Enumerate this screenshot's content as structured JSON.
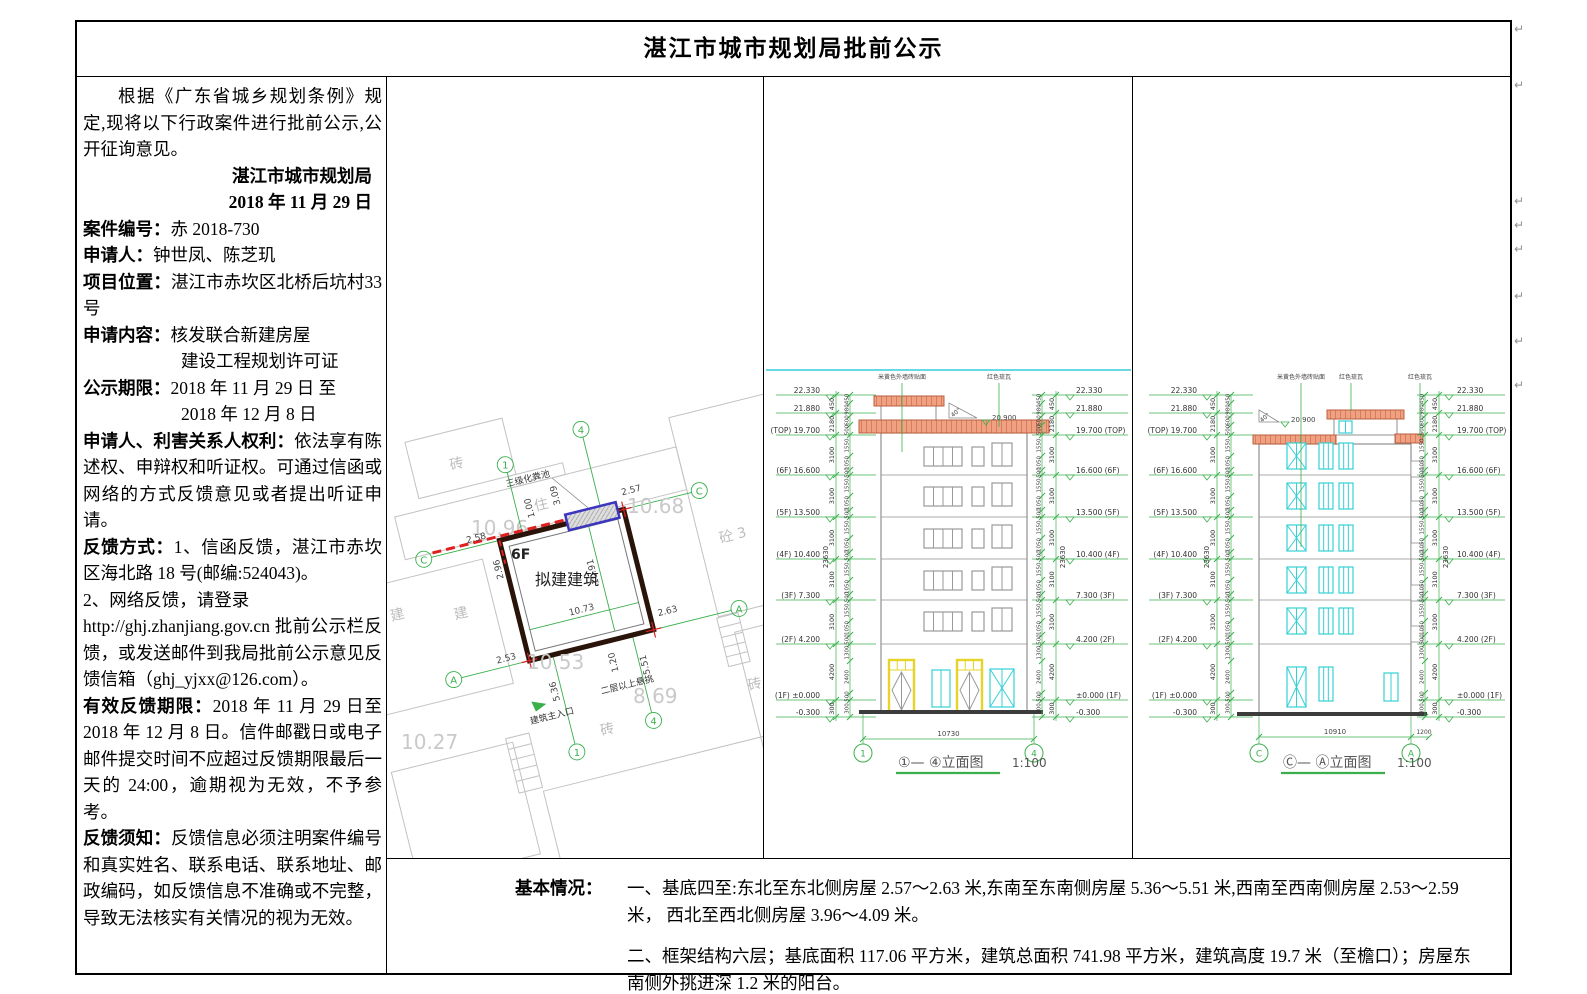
{
  "title": "湛江市城市规划局批前公示",
  "left_panel": {
    "intro": "根据《广东省城乡规划条例》规定,现将以下行政案件进行批前公示,公开征询意见。",
    "agency": "湛江市城市规划局",
    "date": "2018 年 11 月 29 日",
    "case_no_label": "案件编号：",
    "case_no": "赤 2018-730",
    "applicant_label": "申请人：",
    "applicant": "钟世凤、陈芝玑",
    "location_label": "项目位置：",
    "location": "湛江市赤坎区北桥后坑村33 号",
    "content_label": "申请内容：",
    "content1": "核发联合新建房屋",
    "content2": "建设工程规划许可证",
    "period_label": "公示期限：",
    "period1": "2018 年 11 月 29 日  至",
    "period2": "2018 年 12 月 8 日",
    "rights_label": "申请人、利害关系人权利：",
    "rights": "依法享有陈述权、申辩权和听证权。可通过信函或网络的方式反馈意见或者提出听证申请。",
    "feedback_label": "反馈方式：",
    "feedback1": "1、信函反馈，湛江市赤坎区海北路 18 号(邮编:524043)。",
    "feedback2": "2、网络反馈，请登录",
    "feedback3": "http://ghj.zhanjiang.gov.cn 批前公示栏反馈，或发送邮件到我局批前公示意见反馈信箱（ghj_yjxx@126.com）。",
    "deadline_label": "有效反馈期限：",
    "deadline": "2018 年 11 月 29 日至 2018 年 12 月 8 日。信件邮戳日或电子邮件提交时间不应超过反馈期限最后一天的 24:00，逾期视为无效，不予参考。",
    "notice_label": "反馈须知：",
    "notice": "反馈信息必须注明案件编号和真实姓名、联系电话、联系地址、邮政编码，如反馈信息不准确或不完整，导致无法核实有关情况的视为无效。"
  },
  "basic_info": {
    "label": "基本情况：",
    "item1": "一、基底四至:东北至东北侧房屋 2.57～2.63 米,东南至东南侧房屋 5.36～5.51 米,西南至西南侧房屋 2.53～2.59 米， 西北至西北侧房屋 3.96～4.09 米。",
    "item2": "二、框架结构六层；基底面积 117.06 平方米，建筑总面积 741.98 平方米，建筑高度 19.7 米（至檐口）；房屋东南侧外挑进深 1.2 米的阳台。"
  },
  "site_plan": {
    "building_label": "拟建建筑",
    "floors_label": "6F",
    "septic_label": "三级化粪池",
    "entrance_label": "建筑主入口",
    "cantilever_label": "二层以上悬挑",
    "dims": {
      "d257": "2.57",
      "d263": "2.63",
      "d258": "2.58",
      "d253": "2.53",
      "d536": "5.36",
      "d551": "5.51",
      "d120": "1.20",
      "d100": "1.00",
      "d309": "3.09",
      "d296": "2.96",
      "width": "10.73",
      "depth": "10.91"
    },
    "spot_elevations": [
      "10.96",
      "10.68",
      "10.53",
      "8.69",
      "10.27"
    ],
    "neighbors": {
      "top_brick": "砖",
      "house": "住",
      "concrete": "砼 3",
      "j1": "建",
      "j2": "建",
      "brick_b": "砖",
      "brick_r": "砖"
    },
    "grid": {
      "g1": "1",
      "g4": "4",
      "gc": "C",
      "ga": "A"
    }
  },
  "elevations": {
    "levels": [
      {
        "l": "22.330",
        "r": "22.330"
      },
      {
        "l": "21.880",
        "r": "21.880"
      },
      {
        "l": "(TOP) 19.700",
        "r": "19.700 (TOP)"
      },
      {
        "l": "(6F) 16.600",
        "r": "16.600 (6F)"
      },
      {
        "l": "(5F) 13.500",
        "r": "13.500 (5F)"
      },
      {
        "l": "(4F) 10.400",
        "r": "10.400 (4F)"
      },
      {
        "l": "(3F) 7.300",
        "r": "7.300 (3F)"
      },
      {
        "l": "(2F) 4.200",
        "r": "4.200 (2F)"
      },
      {
        "l": "(1F) ±0.000",
        "r": "±0.000 (1F)"
      },
      {
        "l": "-0.300",
        "r": "-0.300"
      }
    ],
    "outer_segments": [
      "450",
      "2180",
      "3100",
      "3100",
      "3100",
      "3100",
      "3100",
      "4200",
      "300"
    ],
    "total": "23630",
    "inner_top": [
      "450",
      "980",
      "600",
      "500"
    ],
    "inner_story": [
      "1550",
      "1050",
      "500"
    ],
    "inner_bottom": [
      "1300",
      "2400",
      "500",
      "300"
    ],
    "ridge_level": "20.900",
    "slope": "40°",
    "ann_wall": "米黄色外墙砖贴面",
    "ann_roof": "红色琉瓦",
    "e1": {
      "caption": "①— ④立面图",
      "scale": "1:100",
      "width_dim": "10730",
      "grid_left": "1",
      "grid_right": "4"
    },
    "e2": {
      "caption": "Ⓒ— Ⓐ立面图",
      "scale": "1:100",
      "width_dim": "10910",
      "balcony_dim": "1200",
      "grid_left": "C",
      "grid_right": "A"
    }
  },
  "colors": {
    "green": "#3aaf4c",
    "roof_fill": "#f0a183",
    "roof_line": "#b95f3f",
    "cyan": "#35d0d6",
    "yellow": "#e6d428",
    "outline": "#8f8f8f",
    "red": "#e02020",
    "blue": "#3c35c0",
    "plan_dark": "#2a1309"
  },
  "icons": {
    "pilcrow": "↵",
    "entrance_triangle": "green-solid-triangle"
  }
}
